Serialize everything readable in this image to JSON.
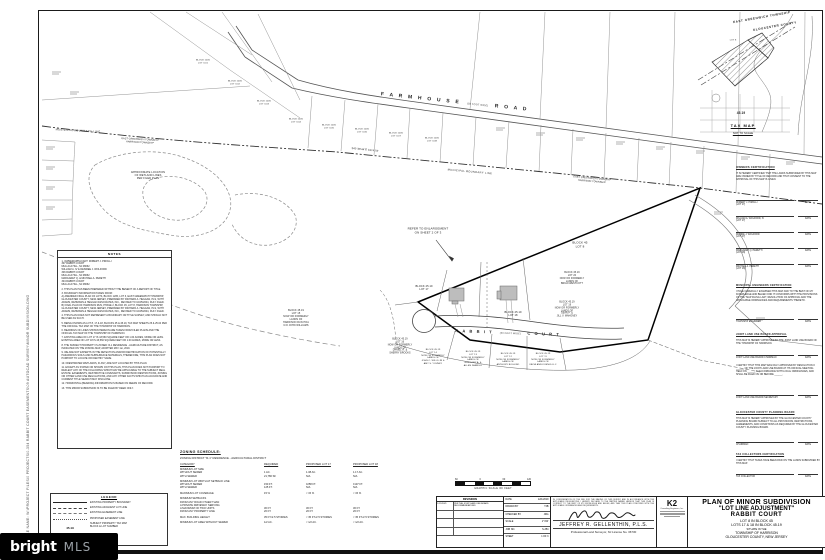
{
  "sheet": {
    "file_path_label": "FILE NAME: W:\\PROJECT FILES\\0 PROJECTS\\0-354 RABBIT COURT EASEMENTS\\09 AUTOCAD SURVEY\\MINOR SUBDIVISION.DWG"
  },
  "watermark": {
    "brand": "bright",
    "suffix": "MLS"
  },
  "tax_map": {
    "header1": "EAST GREENWICH TOWNSHIP",
    "header2": "GLOUCESTER COUNTY",
    "lot8": "LOT 8",
    "block": "45.19",
    "caption": "TAX MAP",
    "scale": "NOT TO SCALE"
  },
  "plan": {
    "roads": {
      "farmhouse": {
        "name1": "F A R M H O U S E",
        "width": "(50 FOOT WIDE)",
        "name2": "R O A D"
      },
      "rabbit": {
        "name1": "R A B B I T",
        "width": "(50 FOOT WIDE)",
        "name2": "C O U R T"
      }
    },
    "boundary": {
      "municipal": "MUNICIPAL BOUNDARY LINE",
      "townships": "EAST GREENWICH TOWNSHIP\nHARRISON TOWNSHIP",
      "bearing": "S42°36'44\"E    1974.78'"
    },
    "callouts": {
      "enlargement": "REFER TO ENLARGEMENT\nON SHEET 2 OF 3",
      "wetlands": "APPROXIMATE LOCATION\nOF WETLAND LINES\nPER FILED PLAN"
    },
    "lots": {
      "lot8": "BLOCK 45\nLOT 8",
      "lot17": "BLOCK 45.19\nLOT 17",
      "lot18": "BLOCK 45.19\nLOT 18",
      "lot15": "BLOCK 45.19\nLOT 15\nNOW OR FORMERLY\nLANDS OF\nHARRISON RUN HOA\nC/O JOHN WILLIAMS",
      "lot16": "BLOCK 45.19\nLOT 16\nNOW OR FORMERLY\nLANDS OF\nDANIEL R. &\nSHERRY BROOKS",
      "lot19": "BLOCK 45.19\nLOT 19\nNOW OR FORMERLY\nLANDS OF\nSEAN P. &\nJILL V. MAHONEY",
      "lot20": "BLOCK 45.19\nLOT 20\nNOW OR FORMERLY\nLANDS OF\nBRIAN WESTCOTT",
      "lot14": "BLOCK 45.19\nLOT 14\nNOW OR FORMERLY\nLANDS OF\nJOHN C. WILLS JR &\nAMY S. YOUNEY",
      "lot13": "BLOCK 45.19\nLOT 13\nNOW OR FORMERLY\nLANDS OF\nGREGORY A. &\nALLEN ZARRILLI",
      "lot12": "BLOCK 45.19\nLOT 12\nNOW OR FORMERLY\nLANDS OF\nANTHONY BOGLINO",
      "lot11": "BLOCK 45.19\nLOT 11\nNOW OR FORMERLY\nLANDS OF\nKATHI ANN KOENIG LLC",
      "b1205_1": "BLOCK 1205\nLOT 3.01",
      "b1205_2": "BLOCK 1205\nLOT 3.02",
      "b1205_3": "BLOCK 1205\nLOT 3.03",
      "b1205_4": "BLOCK 1205\nLOT 3.04",
      "b1205_5": "BLOCK 1205\nLOT 3.05",
      "b1205_6": "BLOCK 1205\nLOT 3.06",
      "b1205_7": "BLOCK 1205\nLOT 3.07",
      "b1205_8": "BLOCK 1205\nLOT 3.08"
    }
  },
  "certs": {
    "date_label": "DATE",
    "owners": {
      "heading": "OWNERS CERTIFICATION",
      "body": "IT IS HEREBY CERTIFIED THAT THE LANDS SUBDIVIDED BY THIS MAP ARE OWNED BY TITLE OF RECORD AND THAT CONSENT TO THE APPROVAL OF THIS MAP IS GIVEN.",
      "sigs": [
        {
          "name": "ROBERT J. PIROLLI\n(LOT 17)"
        },
        {
          "name": "WILLIAM A. WOLFORD, IV\n(LOT 17)"
        },
        {
          "name": "DIANNE J. WOLFORD\n(LOT 17)"
        },
        {
          "name": "MARGARET Q. PERETTI\n(LOT 18)"
        },
        {
          "name": "MICHAEL A. PERETTI\n(LOT 18)"
        }
      ]
    },
    "engineer": {
      "heading": "MUNICIPAL ENGINEERS CERTIFICATION",
      "body": "I HAVE CAREFULLY EXAMINED THIS MAP AND TO THE BEST OF MY KNOWLEDGE AND BELIEF FIND IT CONFORMS WITH THE PROVISIONS OF THE \"MAP FILING LAW\", RESOLUTION OF APPROVAL AND THE APPLICABLE ORDINANCES AND REQUIREMENTS THERETO.",
      "line": "TOWNSHIP ENGINEER"
    },
    "jlub": {
      "heading": "JOINT LAND USE BOARD APPROVAL",
      "body1": "THIS MAP IS HEREBY APPROVED BY THE JOINT LAND USE BOARD OF THE TOWNSHIP OF HARRISON.",
      "line1": "JOINT LAND USE BOARD CHAIRMAN",
      "body2": "I CERTIFY THAT THIS MAP WAS DULY APPROVED BY RESOLUTION # ______ OF THE JOINT LAND USE BOARD AT ITS OFFICIAL MEETING HELD ON ______ IN ACCORDANCE WITH LOCAL ORDINANCES, AND SHALL BE FILED ON OR BEFORE ______.",
      "line2": "JOINT LAND USE BOARD SECRETARY"
    },
    "county": {
      "heading": "GLOUCESTER COUNTY PLANNING BOARD",
      "body": "THIS MAP IS HEREBY APPROVED BY THE GLOUCESTER COUNTY PLANNING BOARD SUBJECT TO ALL PROVISIONS, RESTRICTIONS, AGREEMENTS, AND CONDITIONS AS REQUIRED BY THE GLOUCESTER COUNTY PLANNING BOARD.",
      "line": "CHAIRMAN"
    },
    "tax": {
      "heading": "TAX COLLECTORS CERTIFICATION",
      "body": "I CERTIFY THAT TAXES HAVE BEEN PAID ON THE LANDS SUBDIVIDED BY THIS MAP.",
      "line": "TAX COLLECTOR"
    }
  },
  "notes": {
    "title": "NOTES",
    "items": [
      "1. OWNER/APPLICANT:  ROBERT J. PIROLLI\n307 RABBIT COURT\nMULLICA HILL, NJ 08062\nWILLIAM A. IV & DESIREE J. WOLFORD\n306 RABBIT COURT\nMULLICA HILL, NJ 08062\nMARGARET Q. & MICHAEL A. PERETTI\n304 RABBIT COURT\nMULLICA HILL, NJ 08062",
      "2. THIS PLAN HAS BEEN PREPARED WITHOUT THE BENEFIT OF A REPORT OF TITLE.",
      "3. BOUNDARY INFORMATION TAKEN FROM:\nA) AMENDED FINAL PLAN OF LOTS, BLOCK 1205, LOT 3, EAST GREENWICH TOWNSHIP, GLOUCESTER COUNTY, NEW JERSEY, PREPARED BY RICHARD A. HEGGAN, PLS, WITH ADAMS, REHMANN & HEGGAN ASSOCIATES, INC., REVISED TO 10/25/2004, DULY FILED.\nB) FINAL PLAN OF HARRISON RUN, PHASE 2, BLOCK 45, LOT 8, HARRISON TOWNSHIP, GLOUCESTER COUNTY, NEW JERSEY, PREPARED BY RICHARD A. HEGGAN, PLS, WITH ADAMS, REHMANN & HEGGAN ASSOCIATES, INC., REVISED TO 10/25/2004, DULY FILED.",
      "4. THIS PLAN DOES NOT REPRESENT A BOUNDARY OR TITLE SURVEY, AND SHOULD NOT BE USED AS SUCH.",
      "5. BEING KNOWN AS LOT 8, 17 & 18, BLOCKS 45 & 45.19, TAX MAP SHEETS 25 & 25.04 PER THE OFFICIAL TAX MAP OF THE TOWNSHIP OF HARRISON.",
      "6. BEARINGS OF LINES SHOWN HEREON ARE TAKEN FROM FILED PLANS AND THE OFFICIAL TAX MAP OF THE TOWNSHIP OF HARRISON.",
      "7. EXISTING AREA OF LOT 17 IS 43,560 SQUARE FEET OR 1.00 ACRES, MORE OR LESS. EXISTING AREA OF LOT 18 IS 43,560 SQUARE FEET OR 1.00 ACRES, MORE OR LESS.",
      "8. THE SUBJECT PROPERTY IS ZONED: R-1 RESIDENCE - AGRICULTURE DISTRICT, AS INDICATED ON THE ZONING MAP, ADOPTED MAY 1st, 2019.",
      "9. WE ARE NOT EXPERTS IN THE DETECTION AND/OR IDENTIFICATION OF POTENTIALLY HAZARDOUS SOILS AND SUBSURFACE MATERIALS, THEREFORE, THIS PLAN DOES NOT PURPORT TO LOCATE OR IDENTIFY SAME.",
      "10. FRESHWATER WETLANDS, IF ANY, ARE NOT LOCATED BY THIS PLAN.",
      "11. EXCEPT AS STATED OR SHOWN ON THIS PLAN, THIS PLAN DOES NOT PURPORT TO REFLECT ANY OF THE FOLLOWING WHICH MAY BE APPLICABLE TO THE SUBJECT REAL ESTATE: EASEMENTS, RESTRICTIVE COVENANTS, SUBDIVISION RESTRICTIONS, ZONING OR OTHER LAND USE REGULATIONS, AND ANY OTHER FACTS WHICH AN ACCURATE AND CURRENT TITLE SEARCH MAY DISCLOSE.",
      "12. HORIZONTAL (BEARING) INFORMATION IS BASED ON DEEDS OF RECORD.",
      "13. THIS MINOR SUBDIVISION IS TO BE FILED BY DEED ONLY."
    ]
  },
  "legend": {
    "title": "LEGEND",
    "items": [
      {
        "label": "EXISTING PROPERTY BOUNDARY"
      },
      {
        "label": "EXISTING ADJACENT LOT LINE"
      },
      {
        "label": "EXISTING EASEMENT LINE"
      },
      {
        "label": "PROPOSED EASEMENT LINE"
      },
      {
        "label": "SUBJECT PROPERTY TAX MAP\nBLOCK & LOT NUMBER",
        "sample": "45.19"
      }
    ]
  },
  "zoning": {
    "title": "ZONING SCHEDULE:",
    "district": "ZONING DISTRICT    \"R-1\" RESIDENCE - AGRICULTURAL DISTRICT",
    "headers": {
      "cat": "CATEGORY",
      "req": "REQUIRED",
      "l17": "PROPOSED LOT 17",
      "l18": "PROPOSED LOT 18"
    },
    "rows": [
      {
        "cat": "MINIMUM LOT SIZE\n   WITHOUT SEWER\n   WITH SEWER",
        "req": "\n1 AC.\n21,780 SF",
        "l17": "\n1.38 AC.\nN/A",
        "l18": "\n1.17 AC.\nN/A"
      },
      {
        "cat": "MINIMUM LOT WIDTH AT SETBACK LINE\n   WITHOUT SEWER\n   WITH SEWER",
        "req": "\n150 FT.\n125 FT.",
        "l17": "\n±258 FT.\nN/A",
        "l18": "\n±137 FT.\nN/A"
      },
      {
        "cat": "MAXIMUM LOT COVERAGE",
        "req": "15 %",
        "l17": "< 15 %",
        "l18": "< 15 %"
      },
      {
        "cat": "MINIMUM SETBACKS\n   FROM ANY ROAD OTHER THAN\n   A PRIVATE DRIVEWAY SERVING\n   A MAXIMUM OF TWO UNITS\n   FROM ANY PROPERTY LINE",
        "req": "\n\n\n30 FT.\n20 FT.",
        "l17": "\n\n\n30 FT.\n20 FT.",
        "l18": "\n\n\n30 FT.\n20 FT."
      },
      {
        "cat": "MAX. BUILDING HEIGHT",
        "req": "35 FT./2.5 STORIES",
        "l17": "< 35 FT./2.5 STORIES",
        "l18": "< 35 FT./2.5 STORIES"
      },
      {
        "cat": "MINIMUM LOT AREA WITHOUT SEWER",
        "req": "1/2 AC.",
        "l17": "< 1/2 AC.",
        "l18": "< 1/2 AC."
      }
    ]
  },
  "scale_bar": {
    "t1": "60",
    "t2": "0",
    "t3": "60",
    "t4": "120",
    "caption": "GRAPHIC SCALE OF FEET"
  },
  "revisions": {
    "header": "REVISIONS",
    "entry_date": "1/15/2021",
    "entry_text": "PER THE JOINT LAND USE BOARD RECOMMENDATIONS"
  },
  "info": {
    "date_label": "DATE",
    "date": "12/1/2019",
    "drawn_label": "DRAWN BY",
    "drawn": "TJB",
    "checked_label": "CHECKED BY",
    "checked": "JRG",
    "scale_label": "SCALE",
    "scale": "1\"=60'",
    "job_label": "JOB NO.",
    "job": "S-354",
    "sheet_label": "SHEET",
    "sheet": "1  OF  3"
  },
  "surveyor": {
    "paragraph": "IN CONSIDERATION OF THE FEE FOR THE MAKING OF THIS SURVEY AND IN ACCORDANCE WITH THE APPLICABLE REGULATIONS, I HEREBY DECLARE TO THE PARTIES NAMED HEREON THAT THIS PLAN IS CORRECT TO THE BEST OF MY KNOWLEDGE AND BELIEF, AND THAT THIS PLAN CONFORMS WITH THE APPLICABLE ORDINANCES AND REQUIREMENTS.",
    "name": "JEFFREY R. GELLENTHIN, P.L.S.",
    "sub": "Professional Land Surveyor, NJ License No. 36730"
  },
  "firm": {
    "logo": "K2",
    "line1": "Consulting Engineers, Inc."
  },
  "title_block": {
    "l1": "PLAN OF MINOR SUBDIVISION",
    "l2": "\"LOT LINE ADJUSTMENT\"",
    "l3": "RABBIT COURT",
    "l4": "LOT 8 IN BLOCK 45",
    "l5": "LOTS 17 & 18 IN BLOCK 45.19",
    "l6": "SITUATE IN THE",
    "l7": "TOWNSHIP OF HARRISON",
    "l8": "GLOUCESTER COUNTY, NEW JERSEY"
  }
}
